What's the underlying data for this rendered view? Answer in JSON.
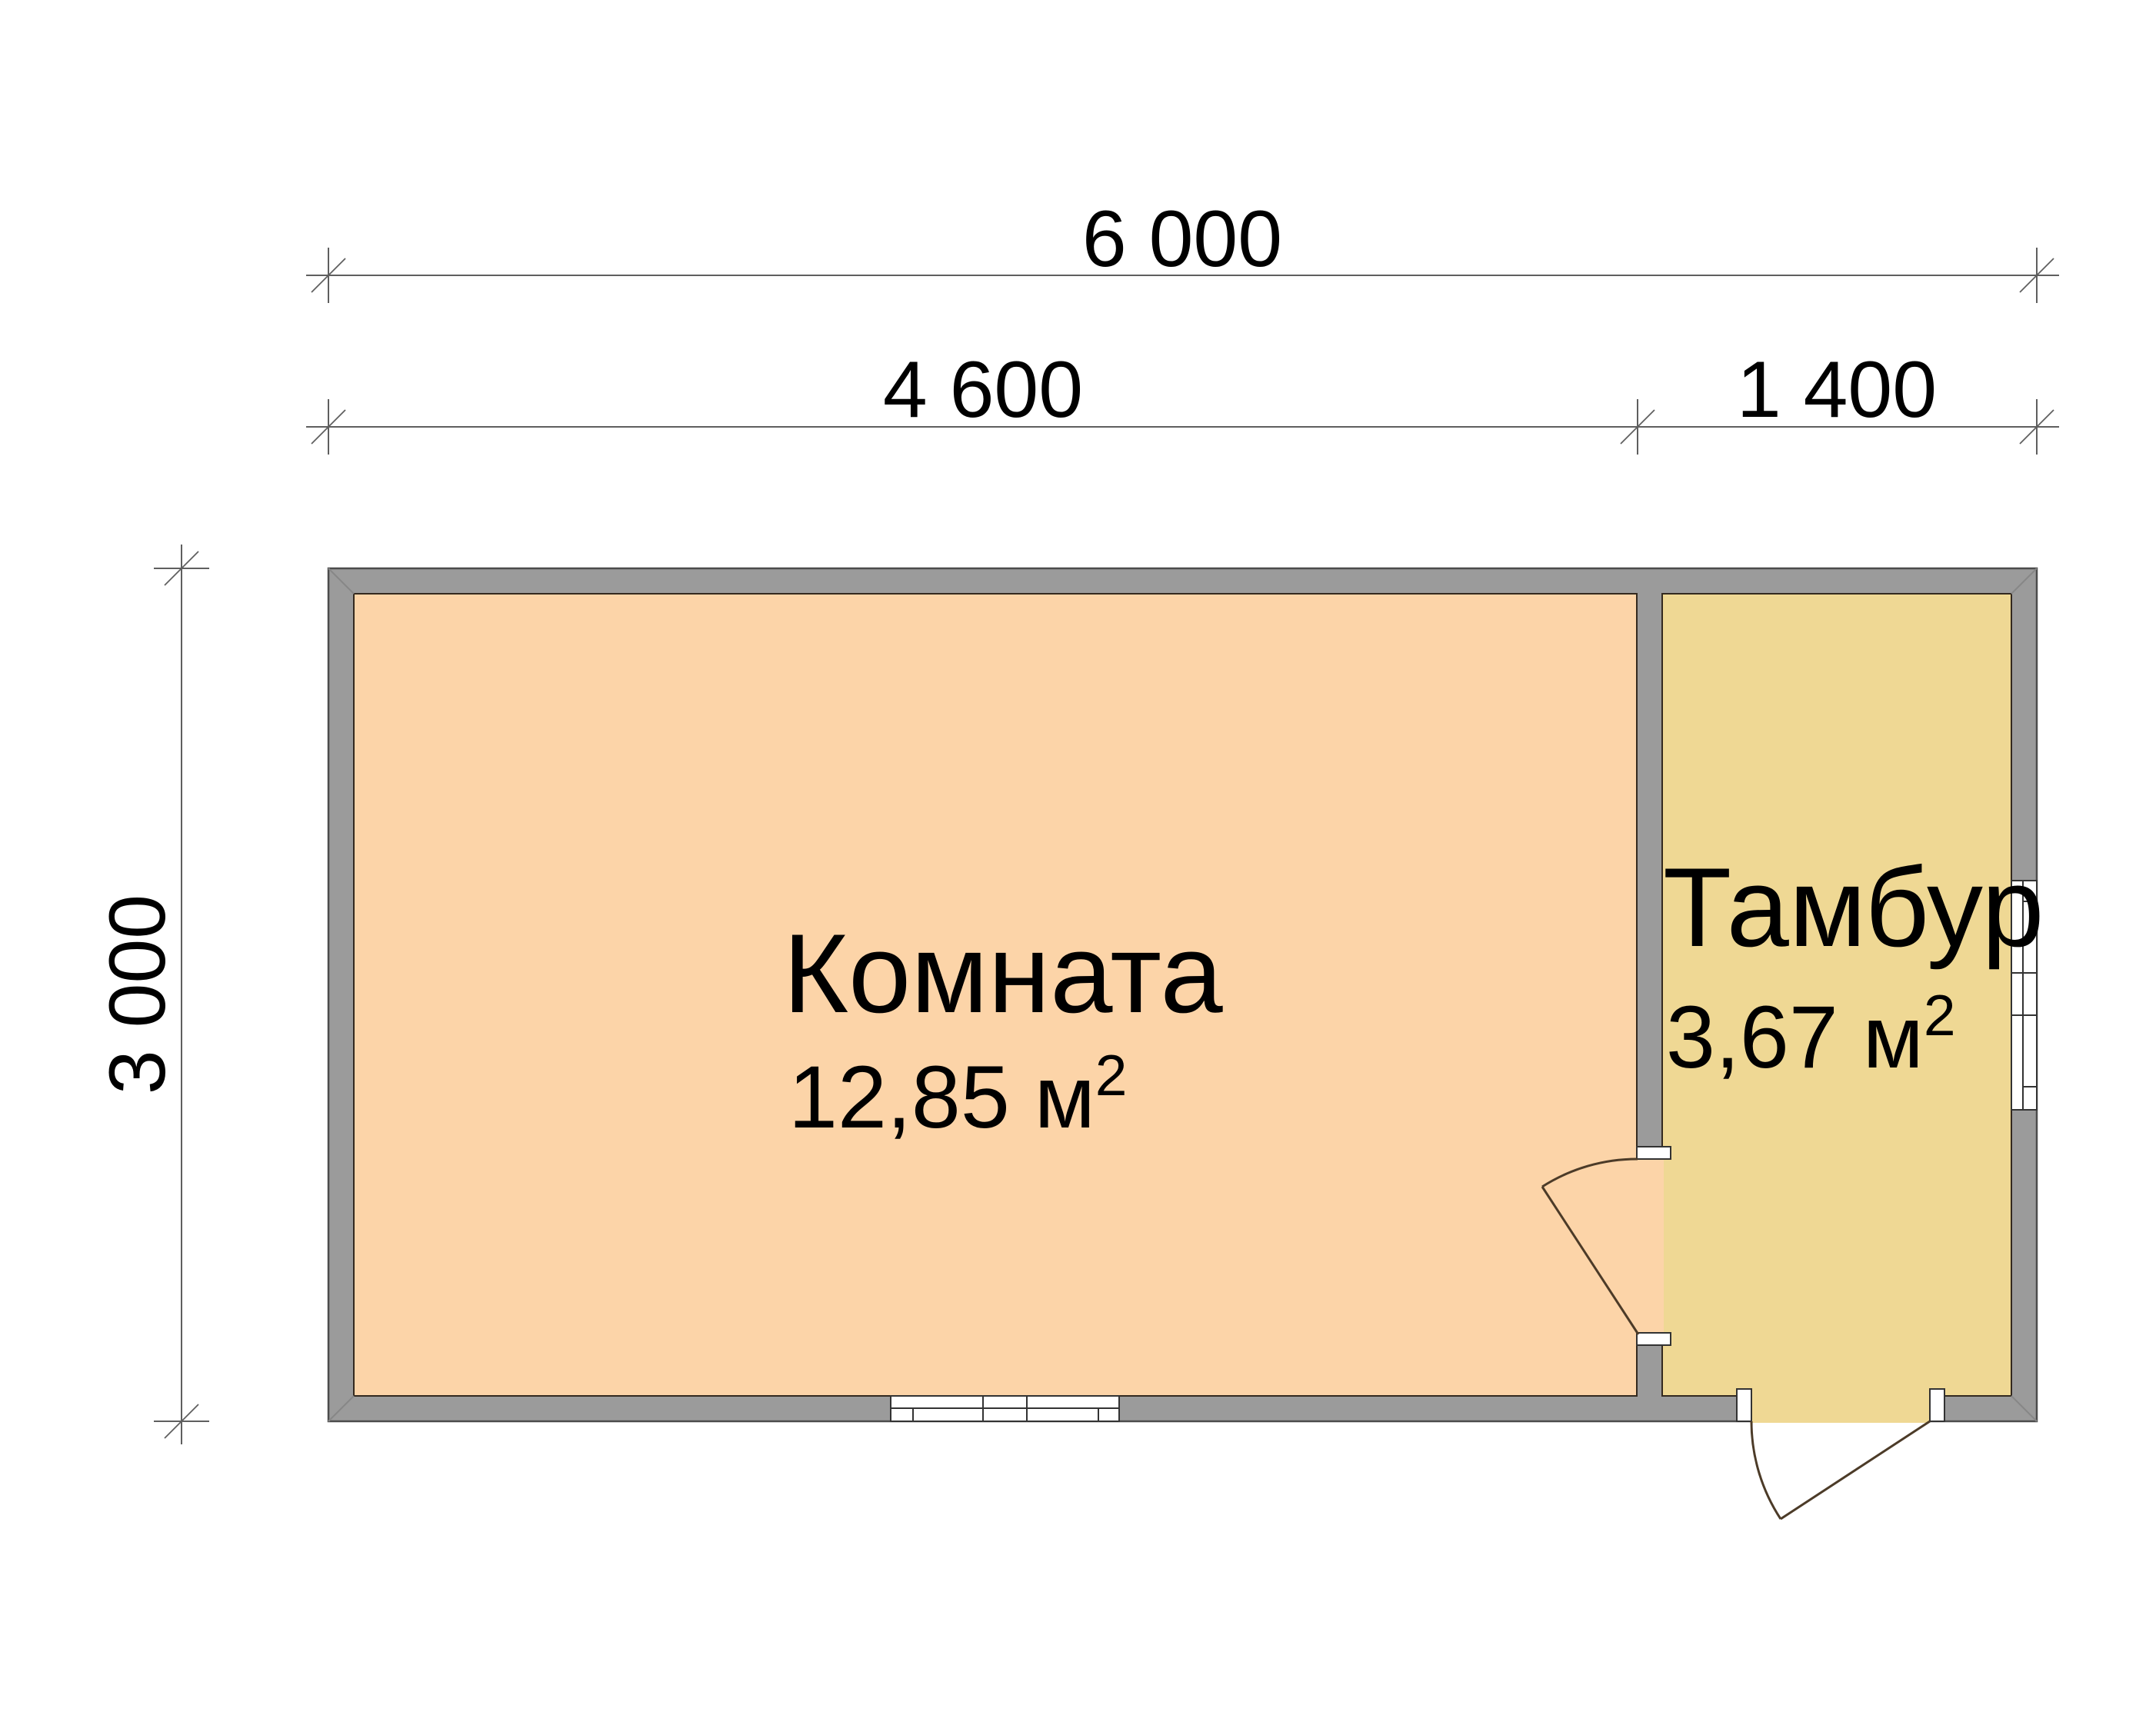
{
  "plan": {
    "dimensions": {
      "total_width": "6 000",
      "room_width": "4 600",
      "tambour_width": "1 400",
      "depth": "3 000"
    },
    "rooms": [
      {
        "name": "Комната",
        "area_text": "12,85 м",
        "area_sup": "2"
      },
      {
        "name": "Тамбур",
        "area_text": "3,67 м",
        "area_sup": "2"
      }
    ],
    "colors": {
      "room_fill": "#FCD4A8",
      "tambour_fill": "#EFD894",
      "wall_fill": "#9B9B9B",
      "dim_line": "#5f5f5f",
      "text": "#000000"
    }
  }
}
